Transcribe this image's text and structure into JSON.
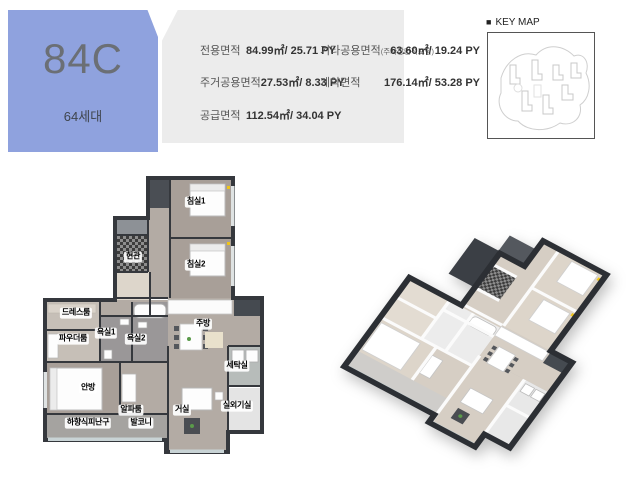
{
  "unit_badge": {
    "code": "84C",
    "households": "64세대"
  },
  "area_table": {
    "left_rows": [
      {
        "label": "전용면적",
        "value": "84.99㎡/ 25.71 PY"
      },
      {
        "label": "주거공용면적",
        "value": "27.53㎡/ 8.33 PY"
      },
      {
        "label": "공급면적",
        "value": "112.54㎡/ 34.04 PY"
      }
    ],
    "right_rows": [
      {
        "label": "기타공용면적",
        "sublabel": "(주차장면적포함)",
        "value": "63.60㎡/ 19.24 PY"
      },
      {
        "label": "계약면적",
        "sublabel": "",
        "value": "176.14㎡/ 53.28 PY"
      }
    ]
  },
  "key_map": {
    "bullet": "■",
    "title": "KEY MAP"
  },
  "floor_plan": {
    "rooms": [
      {
        "label": "침실1"
      },
      {
        "label": "현관"
      },
      {
        "label": "침실2"
      },
      {
        "label": "드레스룸"
      },
      {
        "label": "욕실1"
      },
      {
        "label": "욕실2"
      },
      {
        "label": "파우더룸"
      },
      {
        "label": "주방"
      },
      {
        "label": "세탁실"
      },
      {
        "label": "안방"
      },
      {
        "label": "알파룸"
      },
      {
        "label": "거실"
      },
      {
        "label": "실외기실"
      },
      {
        "label": "하향식피난구"
      },
      {
        "label": "발코니"
      }
    ]
  },
  "colors": {
    "accent_blue": "#8fa2de",
    "panel_gray": "#ececec"
  }
}
